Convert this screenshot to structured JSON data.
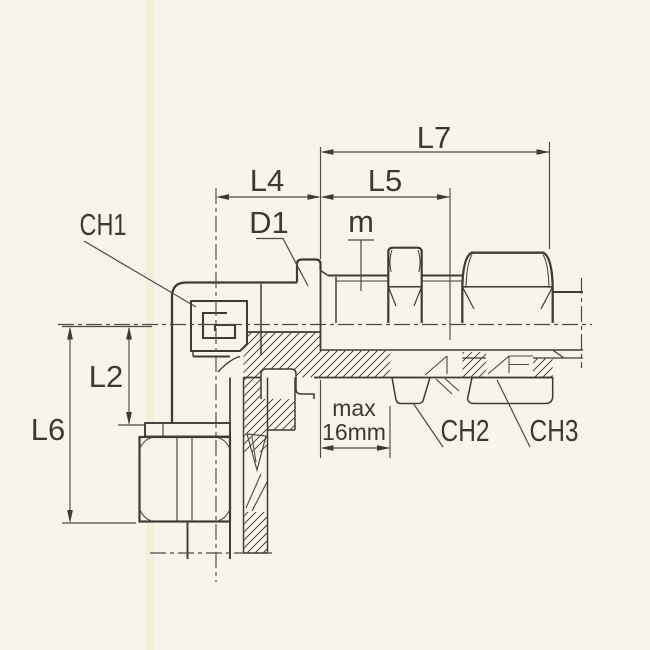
{
  "drawing": {
    "labels": {
      "ch1": "CH1",
      "d1": "D1",
      "m": "m",
      "l4": "L4",
      "l5": "L5",
      "l7": "L7",
      "l2": "L2",
      "l6": "L6",
      "max_wall_line1": "max",
      "max_wall_line2": "16mm",
      "ch2": "CH2",
      "ch3": "CH3"
    },
    "colors": {
      "paper_background": "#f7f4ea",
      "paper_scan_band": "#efe8c4",
      "line_color": "#3c3c36",
      "text_color": "#3a3a34"
    }
  }
}
